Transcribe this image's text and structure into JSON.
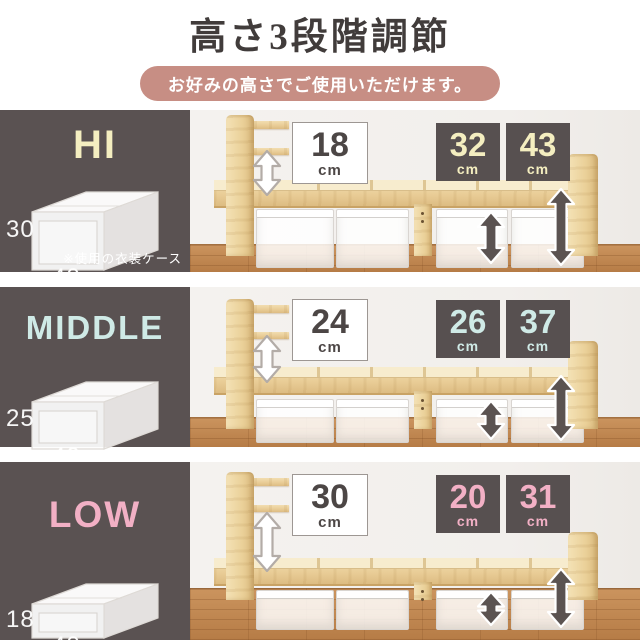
{
  "header": {
    "title": "高さ3段階調節",
    "banner": "お好みの高さでご使用いただけます。"
  },
  "colors": {
    "panel_bg": "#5a5252",
    "banner_bg": "#c78e84",
    "callout_dark_bg": "#575050",
    "hi_accent": "#f4eec0",
    "middle_accent": "#cfeae6",
    "low_accent": "#f2b0c5",
    "bed_wood": "#e9cd97",
    "floor_wood": "#bd8450"
  },
  "rows": [
    {
      "label": "HI",
      "case_height": "30",
      "case_width": "40",
      "note": "※使用の衣装ケース",
      "headboard_gap": {
        "value": "18",
        "unit": "cm"
      },
      "under_bed_1": {
        "value": "32",
        "unit": "cm"
      },
      "under_bed_2": {
        "value": "43",
        "unit": "cm"
      }
    },
    {
      "label": "MIDDLE",
      "case_height": "25",
      "case_width": "40",
      "headboard_gap": {
        "value": "24",
        "unit": "cm"
      },
      "under_bed_1": {
        "value": "26",
        "unit": "cm"
      },
      "under_bed_2": {
        "value": "37",
        "unit": "cm"
      }
    },
    {
      "label": "LOW",
      "case_height": "18",
      "case_width": "40",
      "headboard_gap": {
        "value": "30",
        "unit": "cm"
      },
      "under_bed_1": {
        "value": "20",
        "unit": "cm"
      },
      "under_bed_2": {
        "value": "31",
        "unit": "cm"
      }
    }
  ]
}
